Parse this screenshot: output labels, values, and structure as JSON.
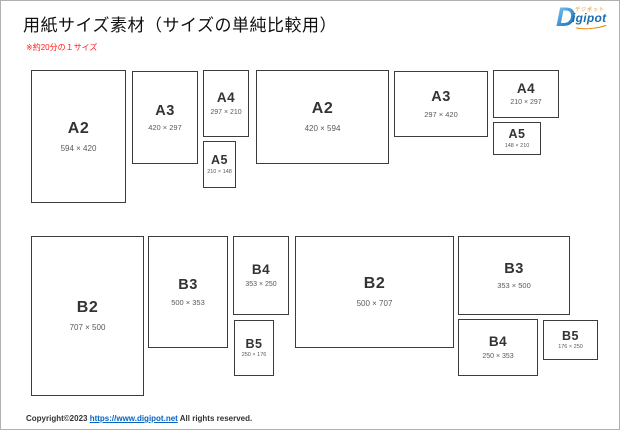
{
  "header": {
    "title": "用紙サイズ素材（サイズの単純比較用）",
    "note": "※約20分の１サイズ",
    "logo": {
      "initial": "D",
      "rest": "igipot",
      "kana": "デジポット"
    }
  },
  "colors": {
    "logo_blue": "#1b6db0",
    "logo_orange": "#f08300",
    "note_red": "#ff1a1a",
    "link_blue": "#0563c1",
    "paper_border": "#3c3c3c"
  },
  "papers": [
    {
      "label": "A2",
      "dims": "594 × 420",
      "orientation": "portrait"
    },
    {
      "label": "A3",
      "dims": "420 × 297",
      "orientation": "portrait"
    },
    {
      "label": "A4",
      "dims": "297 × 210",
      "orientation": "portrait"
    },
    {
      "label": "A5",
      "dims": "210 × 148",
      "orientation": "portrait"
    },
    {
      "label": "A2",
      "dims": "420 × 594",
      "orientation": "landscape"
    },
    {
      "label": "A3",
      "dims": "297 × 420",
      "orientation": "landscape"
    },
    {
      "label": "A4",
      "dims": "210 × 297",
      "orientation": "landscape"
    },
    {
      "label": "A5",
      "dims": "148 × 210",
      "orientation": "landscape"
    },
    {
      "label": "B2",
      "dims": "707 × 500",
      "orientation": "portrait"
    },
    {
      "label": "B3",
      "dims": "500 × 353",
      "orientation": "portrait"
    },
    {
      "label": "B4",
      "dims": "353 × 250",
      "orientation": "portrait"
    },
    {
      "label": "B5",
      "dims": "250 × 176",
      "orientation": "portrait"
    },
    {
      "label": "B2",
      "dims": "500 × 707",
      "orientation": "landscape"
    },
    {
      "label": "B3",
      "dims": "353 × 500",
      "orientation": "landscape"
    },
    {
      "label": "B4",
      "dims": "250 × 353",
      "orientation": "landscape"
    },
    {
      "label": "B5",
      "dims": "176 × 250",
      "orientation": "landscape"
    }
  ],
  "footer": {
    "prefix": "Copyright©2023 ",
    "link": "https://www.digipot.net",
    "suffix": " All rights reserved."
  }
}
